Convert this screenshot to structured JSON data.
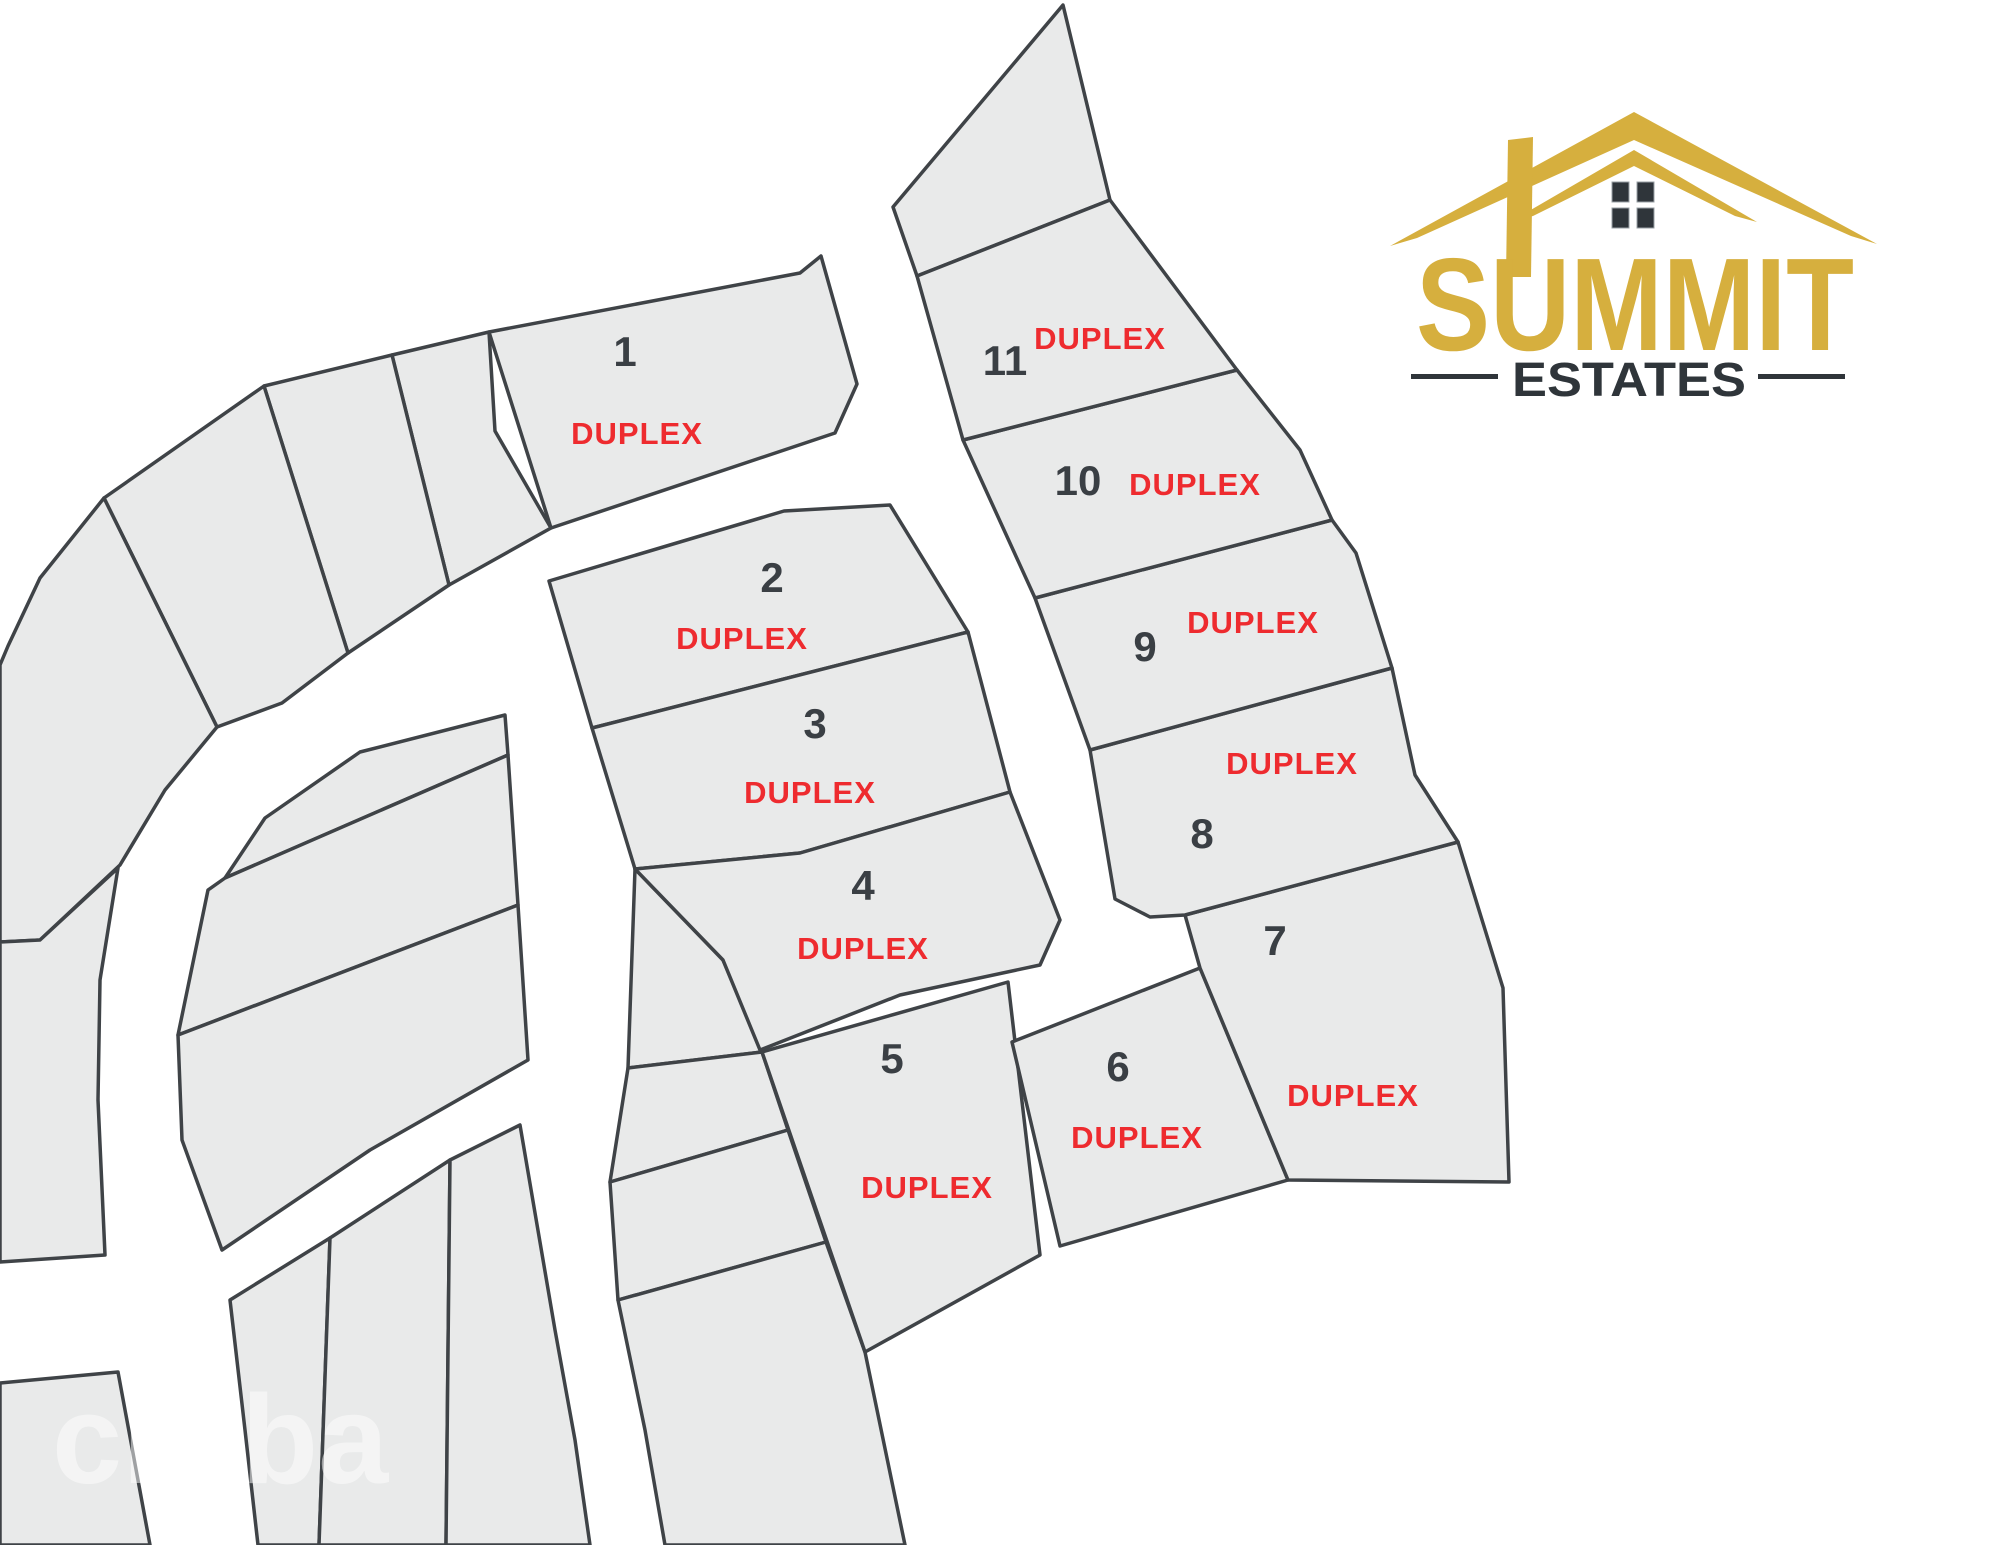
{
  "map": {
    "lot_fill": "#E9EAEA",
    "lot_stroke": "#3F4347",
    "number_color": "#3A3F44",
    "duplex_color": "#EE2B2F",
    "duplex_word": "DUPLEX",
    "lots": [
      {
        "number": "1",
        "poly": "489,332 800,273 821,256 857,384 835,433 551,528",
        "number_pos": [
          625,
          366
        ],
        "duplex_pos": [
          637,
          444
        ]
      },
      {
        "number": "2",
        "poly": "549,581 784,511 890,505 968,632 592,728",
        "number_pos": [
          772,
          592
        ],
        "duplex_pos": [
          742,
          649
        ]
      },
      {
        "number": "3",
        "poly": "592,728 968,632 1010,792 800,853 635,869",
        "number_pos": [
          815,
          738
        ],
        "duplex_pos": [
          810,
          803
        ]
      },
      {
        "number": "4",
        "poly": "635,869 800,853 1010,792 1060,920 1040,965 900,995 760,1050 723,960",
        "number_pos": [
          863,
          900
        ],
        "duplex_pos": [
          863,
          959
        ]
      },
      {
        "number": "5",
        "poly": "762,1052 1008,982 1040,1255 865,1352",
        "number_pos": [
          892,
          1073
        ],
        "duplex_pos": [
          927,
          1198
        ]
      },
      {
        "number": "6",
        "poly": "1012,1042 1200,968 1288,1180 1060,1246",
        "number_pos": [
          1118,
          1081
        ],
        "duplex_pos": [
          1137,
          1148
        ]
      },
      {
        "number": "7",
        "poly": "1185,915 1458,842 1503,988 1509,1182 1288,1180 1200,968",
        "number_pos": [
          1275,
          955
        ],
        "duplex_pos": [
          1353,
          1106
        ]
      },
      {
        "number": "8",
        "poly": "1090,750 1392,668 1415,775 1458,842 1185,915 1150,917 1115,899",
        "number_pos": [
          1202,
          848
        ],
        "duplex_pos": [
          1292,
          774
        ]
      },
      {
        "number": "9",
        "poly": "1035,598 1332,520 1356,553 1392,668 1090,750",
        "number_pos": [
          1145,
          661
        ],
        "duplex_pos": [
          1253,
          633
        ]
      },
      {
        "number": "10",
        "poly": "963,440 1237,370 1300,450 1332,520 1035,598",
        "number_pos": [
          1078,
          495
        ],
        "duplex_pos": [
          1195,
          495
        ]
      },
      {
        "number": "11",
        "poly": "917,276 1110,200 1237,370 963,440",
        "number_pos": [
          1005,
          375
        ],
        "duplex_pos": [
          1100,
          349
        ]
      }
    ],
    "parcels": [
      {
        "name": "triangle-north",
        "poly": "1063,5 893,207 917,276 1110,200"
      },
      {
        "name": "band-1",
        "poly": "392,355 489,332 495,431 551,528 449,585"
      },
      {
        "name": "band-2",
        "poly": "264,386 392,355 449,585 348,653"
      },
      {
        "name": "band-3",
        "poly": "104,498 264,386 348,653 282,703 217,727"
      },
      {
        "name": "band-4",
        "poly": "0,665 8,646 40,578 104,498 217,727 165,790 120,865 40,940 0,942"
      },
      {
        "name": "band-5",
        "poly": "0,942 40,940 118,868 100,980 98,1100 105,1255 0,1262"
      },
      {
        "name": "island-north",
        "poly": "505,715 508,755 225,878 265,818 360,752"
      },
      {
        "name": "island-mid",
        "poly": "508,755 518,905 178,1035 208,890 225,878"
      },
      {
        "name": "island-south",
        "poly": "518,905 528,1060 370,1150 222,1250 182,1140 178,1035"
      },
      {
        "name": "corner-southwest",
        "poly": "0,1383 118,1372 150,1545 0,1545"
      },
      {
        "name": "cluster-a",
        "poly": "230,1300 330,1238 319,1545 258,1545 245,1430"
      },
      {
        "name": "cluster-b",
        "poly": "330,1238 450,1160 446,1545 319,1545"
      },
      {
        "name": "cluster-c",
        "poly": "450,1160 520,1125 555,1330 575,1440 590,1545 446,1545"
      },
      {
        "name": "column-a",
        "poly": "635,869 723,960 762,1052 628,1068"
      },
      {
        "name": "column-b",
        "poly": "628,1068 762,1052 788,1130 610,1182"
      },
      {
        "name": "column-c",
        "poly": "610,1182 788,1130 826,1242 618,1300"
      },
      {
        "name": "column-d",
        "poly": "618,1300 826,1242 865,1352 905,1545 665,1545 645,1430"
      }
    ]
  },
  "logo": {
    "title": "SUMMIT",
    "subtitle": "ESTATES",
    "gold": "#D6AF3E",
    "dark": "#2F353A"
  },
  "watermark": {
    "text": "creba"
  }
}
